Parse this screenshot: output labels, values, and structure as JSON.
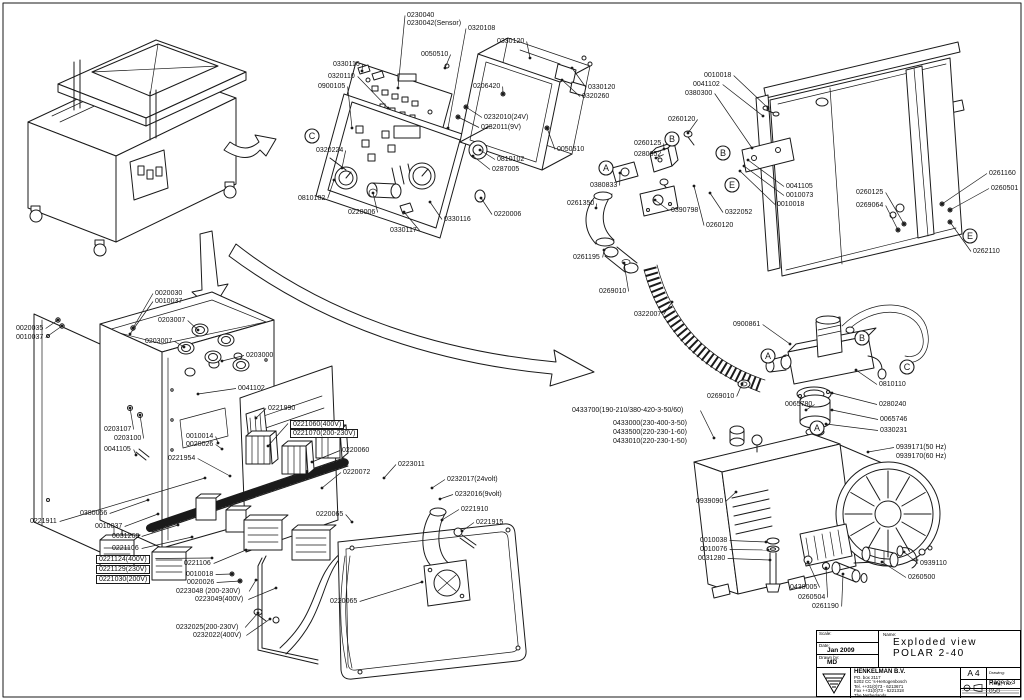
{
  "title_block": {
    "scale_label": "Scale:",
    "date_label": "Date:",
    "date_value": "Jan 2009",
    "drawn_label": "Drawn by:",
    "drawn_value": "MD",
    "name_label": "Name:",
    "name_line1": "Exploded view",
    "name_line2": "POLAR 2-40",
    "company": {
      "name": "HENKELMAN B.V.",
      "address1": "PO. box 2117",
      "address2": "5202 CC  's-Hertogenbosch",
      "tel": "Tel.  ++31(0)73 - 6213671",
      "fax": "Fax  ++31(0)73 - 6221318",
      "country": "The Netherlands"
    },
    "paper_size": "A 4",
    "drawing_label": "Drawing:",
    "page": "Page 1-3",
    "rev": "Rev, no: 050"
  },
  "detail_markers": [
    {
      "letter": "C",
      "x": 312,
      "y": 136
    },
    {
      "letter": "A",
      "x": 606,
      "y": 168
    },
    {
      "letter": "B",
      "x": 672,
      "y": 139
    },
    {
      "letter": "B",
      "x": 723,
      "y": 153
    },
    {
      "letter": "E",
      "x": 732,
      "y": 185
    },
    {
      "letter": "E",
      "x": 970,
      "y": 236
    },
    {
      "letter": "A",
      "x": 768,
      "y": 356
    },
    {
      "letter": "B",
      "x": 862,
      "y": 338
    },
    {
      "letter": "C",
      "x": 907,
      "y": 367
    },
    {
      "letter": "A",
      "x": 817,
      "y": 428
    }
  ],
  "callouts": [
    {
      "t": "0230040",
      "x": 407,
      "y": 12,
      "tx": 398,
      "ty": 88
    },
    {
      "t": "0230042(Sensor)",
      "x": 407,
      "y": 20
    },
    {
      "t": "0320108",
      "x": 468,
      "y": 25,
      "tx": 448,
      "ty": 128
    },
    {
      "t": "0330120",
      "x": 497,
      "y": 38,
      "tx": 530,
      "ty": 58
    },
    {
      "t": "0050510",
      "x": 421,
      "y": 51,
      "tx": 445,
      "ty": 68
    },
    {
      "t": "0330116",
      "x": 333,
      "y": 61,
      "tx": 362,
      "ty": 71
    },
    {
      "t": "0320110",
      "x": 328,
      "y": 73,
      "tx": 388,
      "ty": 108
    },
    {
      "t": "0900105",
      "x": 318,
      "y": 83,
      "tx": 352,
      "ty": 128
    },
    {
      "t": "0206420",
      "x": 473,
      "y": 83,
      "tx": 503,
      "ty": 94
    },
    {
      "t": "0330120",
      "x": 588,
      "y": 84,
      "tx": 572,
      "ty": 68
    },
    {
      "t": "0320260",
      "x": 582,
      "y": 93,
      "tx": 562,
      "ty": 80
    },
    {
      "t": "0232010(24V)",
      "x": 484,
      "y": 114,
      "tx": 466,
      "ty": 107
    },
    {
      "t": "0232011(9V)",
      "x": 481,
      "y": 124,
      "tx": 458,
      "ty": 117
    },
    {
      "t": "0050510",
      "x": 557,
      "y": 146,
      "tx": 547,
      "ty": 128
    },
    {
      "t": "0320224",
      "x": 316,
      "y": 147,
      "tx": 342,
      "ty": 168
    },
    {
      "t": "0810102",
      "x": 497,
      "y": 156,
      "tx": 480,
      "ty": 150
    },
    {
      "t": "0287005",
      "x": 492,
      "y": 166,
      "tx": 473,
      "ty": 156
    },
    {
      "t": "0810102",
      "x": 298,
      "y": 195,
      "tx": 334,
      "ty": 180
    },
    {
      "t": "0220006",
      "x": 348,
      "y": 209,
      "tx": 373,
      "ty": 193
    },
    {
      "t": "0330117",
      "x": 390,
      "y": 227,
      "tx": 404,
      "ty": 212
    },
    {
      "t": "0330116",
      "x": 444,
      "y": 216,
      "tx": 430,
      "ty": 202
    },
    {
      "t": "0220006",
      "x": 494,
      "y": 211,
      "tx": 481,
      "ty": 198
    },
    {
      "t": "0010018",
      "x": 704,
      "y": 72,
      "tx": 768,
      "ty": 108
    },
    {
      "t": "0041102",
      "x": 693,
      "y": 81,
      "tx": 763,
      "ty": 116
    },
    {
      "t": "0380300",
      "x": 685,
      "y": 90,
      "tx": 752,
      "ty": 148
    },
    {
      "t": "0260120",
      "x": 668,
      "y": 116,
      "tx": 688,
      "ty": 133
    },
    {
      "t": "0260125",
      "x": 634,
      "y": 140,
      "tx": 664,
      "ty": 149
    },
    {
      "t": "0280052",
      "x": 634,
      "y": 151,
      "tx": 656,
      "ty": 158
    },
    {
      "t": "0380833",
      "x": 590,
      "y": 182,
      "tx": 620,
      "ty": 173
    },
    {
      "t": "0261350",
      "x": 567,
      "y": 200,
      "tx": 596,
      "ty": 208
    },
    {
      "t": "0390798",
      "x": 671,
      "y": 207,
      "tx": 655,
      "ty": 200
    },
    {
      "t": "0322052",
      "x": 725,
      "y": 209,
      "tx": 710,
      "ty": 193
    },
    {
      "t": "0260120",
      "x": 706,
      "y": 222,
      "tx": 694,
      "ty": 186
    },
    {
      "t": "0041105",
      "x": 786,
      "y": 183,
      "tx": 748,
      "ty": 160
    },
    {
      "t": "0010073",
      "x": 786,
      "y": 192,
      "tx": 744,
      "ty": 166
    },
    {
      "t": "0010018",
      "x": 777,
      "y": 201,
      "tx": 740,
      "ty": 171
    },
    {
      "t": "0260125",
      "x": 856,
      "y": 189,
      "tx": 904,
      "ty": 224
    },
    {
      "t": "0269064",
      "x": 856,
      "y": 202,
      "tx": 898,
      "ty": 230
    },
    {
      "t": "0261160",
      "x": 989,
      "y": 170,
      "tx": 942,
      "ty": 204
    },
    {
      "t": "0260501",
      "x": 991,
      "y": 185,
      "tx": 950,
      "ty": 210
    },
    {
      "t": "0262110",
      "x": 973,
      "y": 248,
      "tx": 950,
      "ty": 222
    },
    {
      "t": "0261195",
      "x": 573,
      "y": 254,
      "tx": 604,
      "ty": 250
    },
    {
      "t": "0269010",
      "x": 599,
      "y": 288,
      "tx": 624,
      "ty": 263
    },
    {
      "t": "0322007",
      "x": 634,
      "y": 311,
      "tx": 672,
      "ty": 302
    },
    {
      "t": "0900861",
      "x": 733,
      "y": 321,
      "tx": 790,
      "ty": 344
    },
    {
      "t": "0269010",
      "x": 707,
      "y": 393,
      "tx": 742,
      "ty": 384
    },
    {
      "t": "0810110",
      "x": 879,
      "y": 381,
      "tx": 856,
      "ty": 370
    },
    {
      "t": "0280240",
      "x": 879,
      "y": 401,
      "tx": 832,
      "ty": 393
    },
    {
      "t": "0065780",
      "x": 785,
      "y": 401,
      "tx": 806,
      "ty": 410
    },
    {
      "t": "0065746",
      "x": 880,
      "y": 416,
      "tx": 832,
      "ty": 410
    },
    {
      "t": "0330231",
      "x": 880,
      "y": 427,
      "tx": 826,
      "ty": 424
    },
    {
      "t": "0939171(50 Hz)",
      "x": 896,
      "y": 444,
      "tx": 868,
      "ty": 452
    },
    {
      "t": "0939170(60 Hz)",
      "x": 896,
      "y": 453
    },
    {
      "t": "0433700(190-210/380-420-3-50/60)",
      "x": 572,
      "y": 407,
      "tx": 714,
      "ty": 438
    },
    {
      "t": "0433000(230-400-3-50)",
      "x": 613,
      "y": 420
    },
    {
      "t": "0433500(220-230-1-60)",
      "x": 613,
      "y": 429
    },
    {
      "t": "0433010(220-230-1-50)",
      "x": 613,
      "y": 438
    },
    {
      "t": "0939090",
      "x": 696,
      "y": 498,
      "tx": 736,
      "ty": 492
    },
    {
      "t": "0010038",
      "x": 700,
      "y": 537,
      "tx": 766,
      "ty": 542
    },
    {
      "t": "0010076",
      "x": 700,
      "y": 546,
      "tx": 768,
      "ty": 550
    },
    {
      "t": "0031280",
      "x": 698,
      "y": 555,
      "tx": 770,
      "ty": 560
    },
    {
      "t": "0438005",
      "x": 790,
      "y": 584,
      "tx": 808,
      "ty": 562
    },
    {
      "t": "0260504",
      "x": 798,
      "y": 594,
      "tx": 826,
      "ty": 568
    },
    {
      "t": "0261190",
      "x": 812,
      "y": 603,
      "tx": 843,
      "ty": 574
    },
    {
      "t": "0939110",
      "x": 920,
      "y": 560,
      "tx": 904,
      "ty": 552
    },
    {
      "t": "0260500",
      "x": 908,
      "y": 574,
      "tx": 882,
      "ty": 562
    },
    {
      "t": "0020030",
      "x": 155,
      "y": 290,
      "tx": 133,
      "ty": 328
    },
    {
      "t": "0010037",
      "x": 155,
      "y": 298,
      "tx": 130,
      "ty": 334
    },
    {
      "t": "0020035",
      "x": 16,
      "y": 325,
      "tx": 58,
      "ty": 320
    },
    {
      "t": "0010037",
      "x": 16,
      "y": 334,
      "tx": 62,
      "ty": 326
    },
    {
      "t": "0203007",
      "x": 158,
      "y": 317,
      "tx": 198,
      "ty": 330
    },
    {
      "t": "0203007",
      "x": 145,
      "y": 338,
      "tx": 184,
      "ty": 347
    },
    {
      "t": "0203000",
      "x": 246,
      "y": 352,
      "tx": 222,
      "ty": 361
    },
    {
      "t": "0041102",
      "x": 238,
      "y": 385,
      "tx": 198,
      "ty": 394
    },
    {
      "t": "0221990",
      "x": 268,
      "y": 405,
      "tx": 256,
      "ty": 418
    },
    {
      "t": "0203107",
      "x": 104,
      "y": 426,
      "tx": 130,
      "ty": 408
    },
    {
      "t": "0203100",
      "x": 114,
      "y": 435,
      "tx": 140,
      "ty": 415
    },
    {
      "t": "0010014",
      "x": 186,
      "y": 433,
      "tx": 218,
      "ty": 443
    },
    {
      "t": "0020026",
      "x": 186,
      "y": 441,
      "tx": 222,
      "ty": 449
    },
    {
      "t": "0041105",
      "x": 104,
      "y": 446,
      "tx": 136,
      "ty": 455
    },
    {
      "t": "0221954",
      "x": 168,
      "y": 455,
      "tx": 230,
      "ty": 476
    },
    {
      "t": "0221060(400V)",
      "x": 290,
      "y": 420,
      "boxed": true,
      "tx": 268,
      "ty": 446
    },
    {
      "t": "0221070(200-230V)",
      "x": 290,
      "y": 429,
      "boxed": true
    },
    {
      "t": "0220060",
      "x": 342,
      "y": 447,
      "tx": 312,
      "ty": 462
    },
    {
      "t": "0220072",
      "x": 343,
      "y": 469,
      "tx": 322,
      "ty": 488
    },
    {
      "t": "0223011",
      "x": 398,
      "y": 461,
      "tx": 384,
      "ty": 478
    },
    {
      "t": "0232017(24volt)",
      "x": 447,
      "y": 476,
      "tx": 432,
      "ty": 488
    },
    {
      "t": "0232016(9volt)",
      "x": 455,
      "y": 491,
      "tx": 440,
      "ty": 499
    },
    {
      "t": "0221910",
      "x": 461,
      "y": 506,
      "tx": 442,
      "ty": 520
    },
    {
      "t": "0221915",
      "x": 476,
      "y": 519,
      "tx": 462,
      "ty": 531
    },
    {
      "t": "0220065",
      "x": 316,
      "y": 511,
      "tx": 352,
      "ty": 522
    },
    {
      "t": "0380066",
      "x": 80,
      "y": 510,
      "tx": 148,
      "ty": 500
    },
    {
      "t": "0010037",
      "x": 95,
      "y": 523,
      "tx": 158,
      "ty": 514
    },
    {
      "t": "0031268",
      "x": 112,
      "y": 533,
      "tx": 178,
      "ty": 525
    },
    {
      "t": "0221106",
      "x": 112,
      "y": 545,
      "tx": 192,
      "ty": 537
    },
    {
      "t": "0221124(400V)",
      "x": 96,
      "y": 555,
      "boxed": true,
      "tx": 212,
      "ty": 558
    },
    {
      "t": "0221129(230V)",
      "x": 96,
      "y": 565,
      "boxed": true
    },
    {
      "t": "0221030(200V)",
      "x": 96,
      "y": 575,
      "boxed": true
    },
    {
      "t": "0221106",
      "x": 184,
      "y": 560,
      "tx": 246,
      "ty": 550
    },
    {
      "t": "0010018",
      "x": 186,
      "y": 571,
      "tx": 232,
      "ty": 574
    },
    {
      "t": "0020026",
      "x": 187,
      "y": 579,
      "tx": 240,
      "ty": 581
    },
    {
      "t": "0223048 (200-230V)",
      "x": 176,
      "y": 588,
      "tx": 256,
      "ty": 580
    },
    {
      "t": "0223049(400V)",
      "x": 195,
      "y": 596,
      "tx": 276,
      "ty": 588
    },
    {
      "t": "0232025(200-230V)",
      "x": 176,
      "y": 624,
      "tx": 258,
      "ty": 613
    },
    {
      "t": "0232022(400V)",
      "x": 193,
      "y": 632,
      "tx": 270,
      "ty": 619
    },
    {
      "t": "0221911",
      "x": 30,
      "y": 518,
      "tx": 205,
      "ty": 478
    },
    {
      "t": "0220065",
      "x": 330,
      "y": 598,
      "tx": 422,
      "ty": 582
    }
  ]
}
